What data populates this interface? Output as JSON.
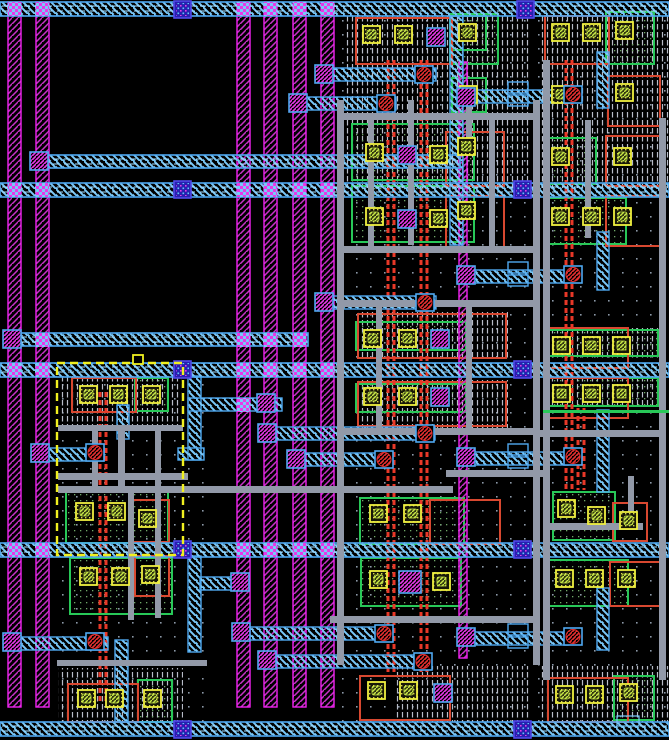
{
  "app": {
    "name": "vlsi-layout-editor",
    "view": "layout-canvas"
  },
  "canvas": {
    "width": 669,
    "height": 740,
    "background": "#000000"
  },
  "palette": {
    "stripe_border": "#F222F2",
    "stripe_hatch": "#C832C8",
    "band_border": "#4FA8F0",
    "band_hatch": "#79C8F8",
    "band_dash": "#A8E0FF",
    "gray": "#9299A8",
    "poly": "#E83828",
    "orange": "#D84830",
    "green": "#28C858",
    "yellow": "#F0F040",
    "contact_dot": "#D8D848",
    "lime": "#C8E848",
    "dense": "#B8BCC8",
    "dot": "#8C98A8",
    "celldot": "#70A868",
    "via_b_fill": "#2820B0",
    "via_b_border": "#5048E8",
    "via_b_dot1": "#E838E8",
    "via_b_dot2": "#60C8F8",
    "via_m": "#E838E8",
    "via_r": "#E83030",
    "select": "#F0F020",
    "label_border": "#79C8F8"
  },
  "layout": {
    "dot_regions": [
      [
        330,
        16,
        339,
        724
      ],
      [
        55,
        363,
        150,
        360
      ]
    ],
    "dense_regions": [
      [
        346,
        16,
        184,
        172
      ],
      [
        540,
        16,
        129,
        172
      ],
      [
        60,
        376,
        122,
        56
      ],
      [
        58,
        668,
        125,
        54
      ],
      [
        395,
        666,
        135,
        56
      ],
      [
        540,
        666,
        129,
        56
      ],
      [
        358,
        312,
        150,
        48
      ],
      [
        358,
        380,
        150,
        48
      ],
      [
        545,
        328,
        120,
        30
      ],
      [
        545,
        376,
        120,
        30
      ]
    ],
    "green_frames": [
      [
        450,
        14,
        48,
        50
      ],
      [
        606,
        12,
        48,
        52
      ],
      [
        352,
        124,
        122,
        56
      ],
      [
        352,
        186,
        122,
        56
      ],
      [
        544,
        138,
        52,
        46
      ],
      [
        544,
        198,
        82,
        46
      ],
      [
        356,
        322,
        110,
        28
      ],
      [
        356,
        384,
        110,
        28
      ],
      [
        548,
        330,
        110,
        26
      ],
      [
        548,
        378,
        110,
        28
      ],
      [
        66,
        487,
        102,
        56
      ],
      [
        360,
        498,
        104,
        46
      ],
      [
        553,
        492,
        62,
        48
      ],
      [
        70,
        558,
        102,
        56
      ],
      [
        361,
        558,
        100,
        48
      ],
      [
        548,
        560,
        80,
        46
      ],
      [
        138,
        680,
        34,
        42
      ],
      [
        614,
        676,
        40,
        44
      ],
      [
        135,
        378,
        33,
        33
      ],
      [
        452,
        78,
        34,
        34
      ],
      [
        452,
        16,
        34,
        34
      ]
    ],
    "orange_frames": [
      [
        356,
        18,
        96,
        46
      ],
      [
        545,
        16,
        64,
        48
      ],
      [
        608,
        76,
        52,
        50
      ],
      [
        446,
        132,
        58,
        54
      ],
      [
        446,
        196,
        58,
        54
      ],
      [
        606,
        136,
        54,
        50
      ],
      [
        606,
        196,
        54,
        50
      ],
      [
        358,
        314,
        148,
        44
      ],
      [
        358,
        382,
        148,
        44
      ],
      [
        546,
        328,
        82,
        40
      ],
      [
        546,
        378,
        82,
        40
      ],
      [
        133,
        500,
        36,
        42
      ],
      [
        430,
        500,
        70,
        44
      ],
      [
        613,
        503,
        34,
        38
      ],
      [
        135,
        556,
        34,
        40
      ],
      [
        610,
        562,
        50,
        44
      ],
      [
        68,
        684,
        70,
        38
      ],
      [
        360,
        676,
        90,
        44
      ],
      [
        548,
        678,
        80,
        44
      ],
      [
        72,
        378,
        64,
        34
      ]
    ],
    "poly_pairs": [
      [
        100,
        392,
        312
      ],
      [
        388,
        60,
        612
      ],
      [
        421,
        60,
        612
      ],
      [
        566,
        60,
        430
      ],
      [
        578,
        408,
        82
      ]
    ],
    "stripes": [
      [
        8,
        2,
        13,
        705
      ],
      [
        36,
        2,
        13,
        705
      ],
      [
        237,
        2,
        13,
        705
      ],
      [
        264,
        2,
        13,
        705
      ],
      [
        293,
        2,
        13,
        705
      ],
      [
        321,
        2,
        13,
        705
      ],
      [
        459,
        62,
        8,
        596
      ]
    ],
    "cyan_verticals": [
      [
        450,
        16,
        13,
        229
      ],
      [
        597,
        52,
        12,
        56
      ],
      [
        597,
        232,
        12,
        58
      ],
      [
        597,
        410,
        12,
        82
      ],
      [
        597,
        588,
        12,
        62
      ],
      [
        115,
        640,
        13,
        82
      ],
      [
        188,
        376,
        13,
        84
      ],
      [
        188,
        556,
        13,
        96
      ],
      [
        117,
        405,
        12,
        34
      ]
    ],
    "wires": [
      [
        318,
        68,
        118,
        13
      ],
      [
        292,
        97,
        104,
        13
      ],
      [
        318,
        296,
        118,
        13
      ],
      [
        188,
        398,
        94,
        13
      ],
      [
        36,
        448,
        68,
        13
      ],
      [
        263,
        427,
        172,
        13
      ],
      [
        292,
        453,
        100,
        13
      ],
      [
        200,
        577,
        38,
        13
      ],
      [
        237,
        627,
        152,
        13
      ],
      [
        263,
        655,
        168,
        13
      ],
      [
        8,
        637,
        100,
        13
      ],
      [
        462,
        90,
        106,
        13
      ],
      [
        462,
        270,
        106,
        13
      ],
      [
        462,
        452,
        106,
        13
      ],
      [
        462,
        632,
        106,
        13
      ],
      [
        178,
        448,
        26,
        12
      ]
    ],
    "bands_full": [
      [
        0,
        2,
        669,
        14
      ],
      [
        0,
        183,
        669,
        14
      ],
      [
        0,
        363,
        669,
        14
      ],
      [
        0,
        543,
        669,
        14
      ],
      [
        0,
        722,
        669,
        14
      ]
    ],
    "bands_partial": [
      [
        40,
        155,
        420,
        13
      ],
      [
        8,
        333,
        300,
        13
      ]
    ],
    "checkers": [
      [
        8,
        2
      ],
      [
        36,
        2
      ],
      [
        237,
        2
      ],
      [
        264,
        2
      ],
      [
        293,
        2
      ],
      [
        321,
        2
      ],
      [
        8,
        183
      ],
      [
        36,
        183
      ],
      [
        237,
        183
      ],
      [
        264,
        183
      ],
      [
        293,
        183
      ],
      [
        321,
        183
      ],
      [
        8,
        363
      ],
      [
        36,
        363
      ],
      [
        237,
        363
      ],
      [
        264,
        363
      ],
      [
        293,
        363
      ],
      [
        321,
        363
      ],
      [
        8,
        543
      ],
      [
        36,
        543
      ],
      [
        237,
        543
      ],
      [
        264,
        543
      ],
      [
        293,
        543
      ],
      [
        321,
        543
      ],
      [
        36,
        155
      ],
      [
        8,
        333
      ],
      [
        36,
        333
      ],
      [
        237,
        333
      ],
      [
        264,
        333
      ],
      [
        293,
        333
      ],
      [
        237,
        398
      ]
    ],
    "gray_v": [
      [
        337,
        100,
        7,
        565
      ],
      [
        533,
        100,
        7,
        565
      ],
      [
        543,
        60,
        7,
        620
      ],
      [
        659,
        118,
        7,
        562
      ],
      [
        368,
        118,
        6,
        130
      ],
      [
        489,
        118,
        6,
        130
      ],
      [
        408,
        100,
        6,
        145
      ],
      [
        466,
        100,
        6,
        38
      ],
      [
        118,
        425,
        7,
        68
      ],
      [
        155,
        430,
        6,
        188
      ],
      [
        585,
        120,
        6,
        118
      ],
      [
        628,
        476,
        6,
        48
      ],
      [
        92,
        430,
        6,
        60
      ],
      [
        128,
        490,
        6,
        130
      ],
      [
        376,
        302,
        6,
        126
      ],
      [
        466,
        302,
        6,
        126
      ]
    ],
    "gray_h": [
      [
        337,
        113,
        196,
        7
      ],
      [
        337,
        246,
        196,
        7
      ],
      [
        337,
        300,
        196,
        7
      ],
      [
        340,
        428,
        193,
        7
      ],
      [
        540,
        430,
        126,
        7
      ],
      [
        446,
        470,
        100,
        7
      ],
      [
        58,
        473,
        130,
        7
      ],
      [
        58,
        486,
        395,
        7
      ],
      [
        330,
        616,
        203,
        7
      ],
      [
        543,
        523,
        100,
        7
      ],
      [
        58,
        425,
        125,
        6
      ],
      [
        57,
        660,
        150,
        6
      ]
    ],
    "green_lines": [
      [
        543,
        410,
        126,
        3
      ]
    ],
    "steps": [
      [
        508,
        82,
        20,
        11
      ],
      [
        508,
        95,
        20,
        11
      ],
      [
        508,
        262,
        20,
        11
      ],
      [
        508,
        275,
        20,
        11
      ],
      [
        508,
        444,
        20,
        11
      ],
      [
        508,
        457,
        20,
        11
      ],
      [
        508,
        624,
        20,
        11
      ],
      [
        508,
        637,
        20,
        11
      ]
    ],
    "contacts": [
      [
        363,
        26
      ],
      [
        395,
        26
      ],
      [
        459,
        24
      ],
      [
        552,
        24
      ],
      [
        583,
        24
      ],
      [
        616,
        22
      ],
      [
        460,
        86
      ],
      [
        552,
        86
      ],
      [
        616,
        84
      ],
      [
        366,
        144
      ],
      [
        430,
        146
      ],
      [
        458,
        138
      ],
      [
        366,
        208
      ],
      [
        430,
        210
      ],
      [
        458,
        202
      ],
      [
        552,
        148
      ],
      [
        614,
        148
      ],
      [
        552,
        208
      ],
      [
        583,
        208
      ],
      [
        614,
        208
      ],
      [
        364,
        330
      ],
      [
        399,
        330
      ],
      [
        364,
        388
      ],
      [
        399,
        388
      ],
      [
        553,
        337
      ],
      [
        583,
        337
      ],
      [
        613,
        337
      ],
      [
        553,
        385
      ],
      [
        583,
        385
      ],
      [
        613,
        385
      ],
      [
        76,
        503
      ],
      [
        108,
        503
      ],
      [
        139,
        510
      ],
      [
        370,
        505
      ],
      [
        404,
        505
      ],
      [
        558,
        500
      ],
      [
        588,
        507
      ],
      [
        620,
        512
      ],
      [
        80,
        568
      ],
      [
        112,
        568
      ],
      [
        142,
        566
      ],
      [
        370,
        571
      ],
      [
        433,
        573
      ],
      [
        556,
        570
      ],
      [
        586,
        570
      ],
      [
        618,
        570
      ],
      [
        78,
        690
      ],
      [
        106,
        690
      ],
      [
        144,
        690
      ],
      [
        368,
        682
      ],
      [
        400,
        682
      ],
      [
        556,
        686
      ],
      [
        586,
        686
      ],
      [
        620,
        684
      ],
      [
        80,
        386
      ],
      [
        110,
        386
      ],
      [
        143,
        386
      ]
    ],
    "vias_m": [
      [
        315,
        65
      ],
      [
        289,
        94
      ],
      [
        315,
        293
      ],
      [
        257,
        394
      ],
      [
        31,
        444
      ],
      [
        258,
        424
      ],
      [
        287,
        450
      ],
      [
        231,
        573
      ],
      [
        232,
        623
      ],
      [
        258,
        651
      ],
      [
        3,
        633
      ],
      [
        457,
        88
      ],
      [
        457,
        266
      ],
      [
        457,
        448
      ],
      [
        457,
        628
      ],
      [
        30,
        152
      ],
      [
        3,
        330
      ],
      [
        427,
        28
      ],
      [
        398,
        146
      ],
      [
        398,
        210
      ],
      [
        431,
        330
      ],
      [
        431,
        388
      ],
      [
        399,
        571,
        22
      ],
      [
        434,
        684
      ]
    ],
    "vias_r": [
      [
        415,
        66
      ],
      [
        377,
        95
      ],
      [
        416,
        294
      ],
      [
        86,
        444
      ],
      [
        416,
        425
      ],
      [
        375,
        451
      ],
      [
        375,
        625
      ],
      [
        414,
        653
      ],
      [
        86,
        633
      ],
      [
        564,
        86
      ],
      [
        564,
        266
      ],
      [
        564,
        448
      ],
      [
        564,
        628
      ]
    ],
    "vias_b": [
      [
        174,
        1
      ],
      [
        517,
        1
      ],
      [
        174,
        181
      ],
      [
        514,
        181
      ],
      [
        174,
        361
      ],
      [
        514,
        361
      ],
      [
        174,
        541
      ],
      [
        514,
        541
      ],
      [
        174,
        721
      ],
      [
        514,
        721
      ]
    ],
    "selection": {
      "x": 57,
      "y": 363,
      "w": 126,
      "h": 192,
      "marker": [
        133,
        355,
        10,
        9
      ]
    },
    "label_box": [
      617,
      716,
      22,
      10
    ]
  }
}
